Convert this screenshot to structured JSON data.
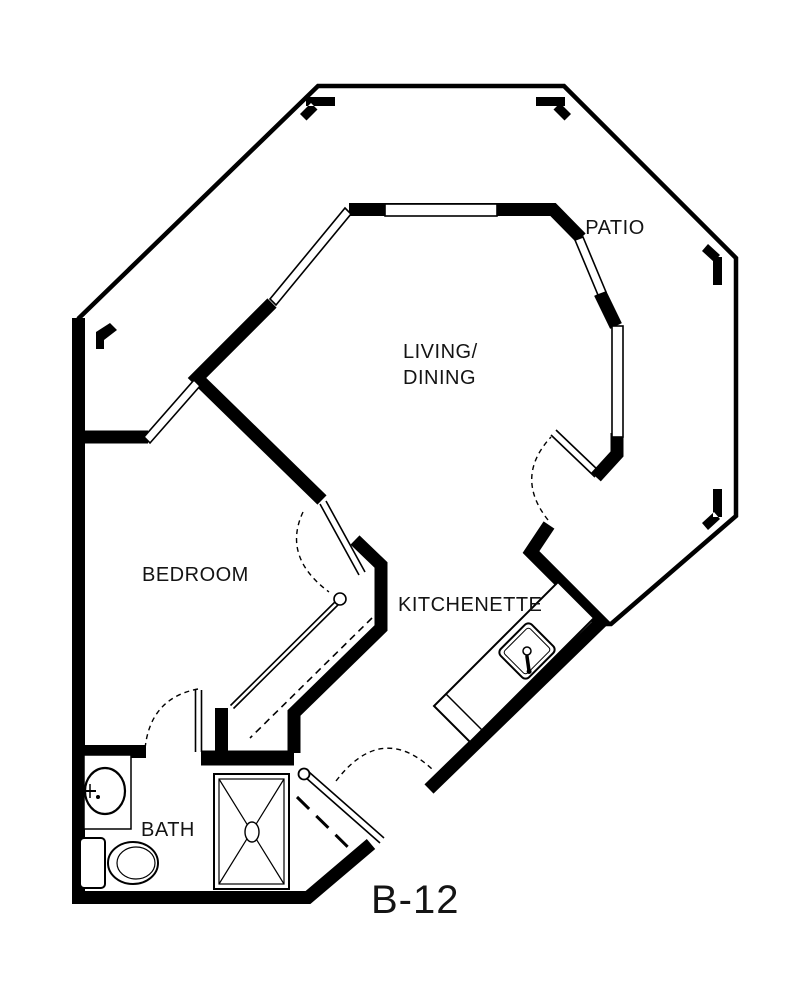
{
  "plan": {
    "unit_number": "B-12",
    "rooms": {
      "patio": "PATIO",
      "living_dining_line1": "LIVING/",
      "living_dining_line2": "DINING",
      "bedroom": "BEDROOM",
      "kitchenette": "KITCHENETTE",
      "bath": "BATH"
    },
    "colors": {
      "wall": "#000000",
      "background": "#ffffff",
      "text": "#141414"
    }
  }
}
